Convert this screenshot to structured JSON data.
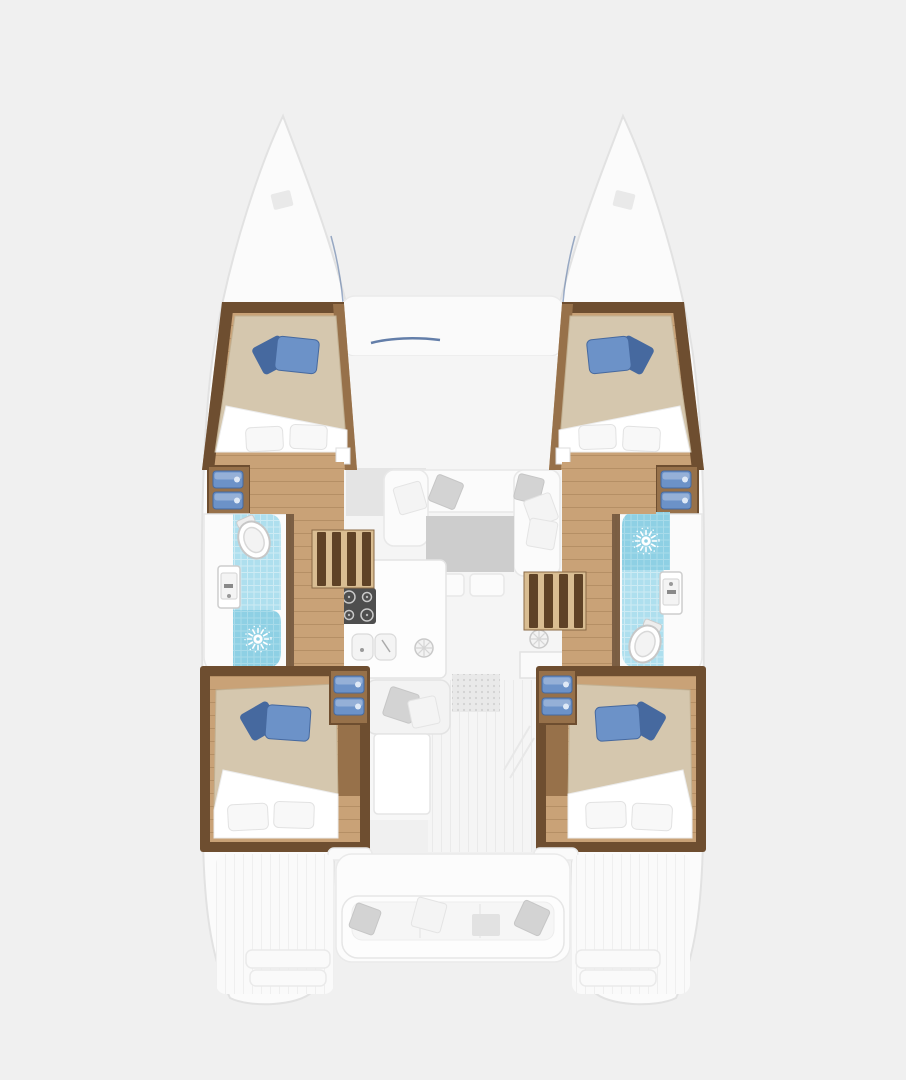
{
  "image": {
    "type": "boat-floor-plan",
    "subject": "catamaran",
    "view": "top-down",
    "orientation": "bow-up"
  },
  "colors": {
    "bg": "#f0f0f0",
    "hullFill": "#fbfbfb",
    "hullStroke": "#e2e2e2",
    "deckWhite": "#fafafa",
    "deckStroke": "#eaeaea",
    "cockpitGray": "#f7f7f7",
    "woodDark": "#6e4e30",
    "woodMid": "#97714a",
    "woodFloor": "#c9a277",
    "woodFloorLight": "#d9bd92",
    "stepDark": "#5f4226",
    "bedBlanket": "#d5c7ae",
    "bedEdge": "#c2b193",
    "sheetWhite": "#ffffff",
    "pillowWhite": "#f8f8f8",
    "pillowStroke": "#e2e2e2",
    "cushionBlue": "#6c92c8",
    "cushionBlueDark": "#46699f",
    "tileBlue": "#aedfee",
    "showerBlue": "#8ed0e4",
    "fixtureWhite": "#ffffff",
    "fixtureStroke": "#cdcdcd",
    "sofaWhite": "#fbfbfb",
    "sofaStroke": "#e8e8e8",
    "tableGray": "#cdcdcd",
    "grayPillow": "#d3d3d3",
    "stoveDark": "#4e4e4e",
    "matGray": "#e9e9e9",
    "navy": "#3d5f95"
  },
  "icons": {
    "shower": "sun-ray-showerhead",
    "toilet": "oval-bowl",
    "stove": "four-burner-cooktop",
    "galley_sink": "double-basin",
    "hatch": "round-spoked-hatch"
  },
  "scene": {
    "hulls": [
      {
        "id": "port",
        "rooms": [
          {
            "name": "forward-cabin",
            "furniture": [
              "double-bed",
              "blue-cushions",
              "white-pillows"
            ]
          },
          {
            "name": "bathroom",
            "fixtures": [
              "toilet",
              "washbasin",
              "shower"
            ]
          },
          {
            "name": "aft-cabin",
            "furniture": [
              "double-bed",
              "blue-cushions",
              "white-pillows",
              "storage-drawers"
            ]
          }
        ],
        "circulation": [
          "corridor",
          "companionway-stairs"
        ]
      },
      {
        "id": "starboard",
        "rooms": [
          {
            "name": "forward-cabin",
            "furniture": [
              "double-bed",
              "blue-cushions",
              "white-pillows"
            ]
          },
          {
            "name": "bathroom",
            "fixtures": [
              "shower",
              "washbasin",
              "toilet"
            ]
          },
          {
            "name": "aft-cabin",
            "furniture": [
              "double-bed",
              "blue-cushions",
              "white-pillows",
              "storage-drawers"
            ]
          }
        ],
        "circulation": [
          "corridor",
          "companionway-stairs"
        ]
      }
    ],
    "bridgedeck": {
      "areas": [
        {
          "name": "forward-cockpit",
          "furniture": [
            "bench-seat",
            "pillows"
          ]
        },
        {
          "name": "saloon",
          "furniture": [
            "sofa",
            "table",
            "pillows",
            "side-counter"
          ]
        },
        {
          "name": "galley",
          "fixtures": [
            "cooktop",
            "double-sink",
            "round-hatch"
          ]
        },
        {
          "name": "aft-cockpit",
          "furniture": [
            "bench-seat",
            "pillows",
            "small-table",
            "transom-steps"
          ]
        }
      ]
    }
  }
}
